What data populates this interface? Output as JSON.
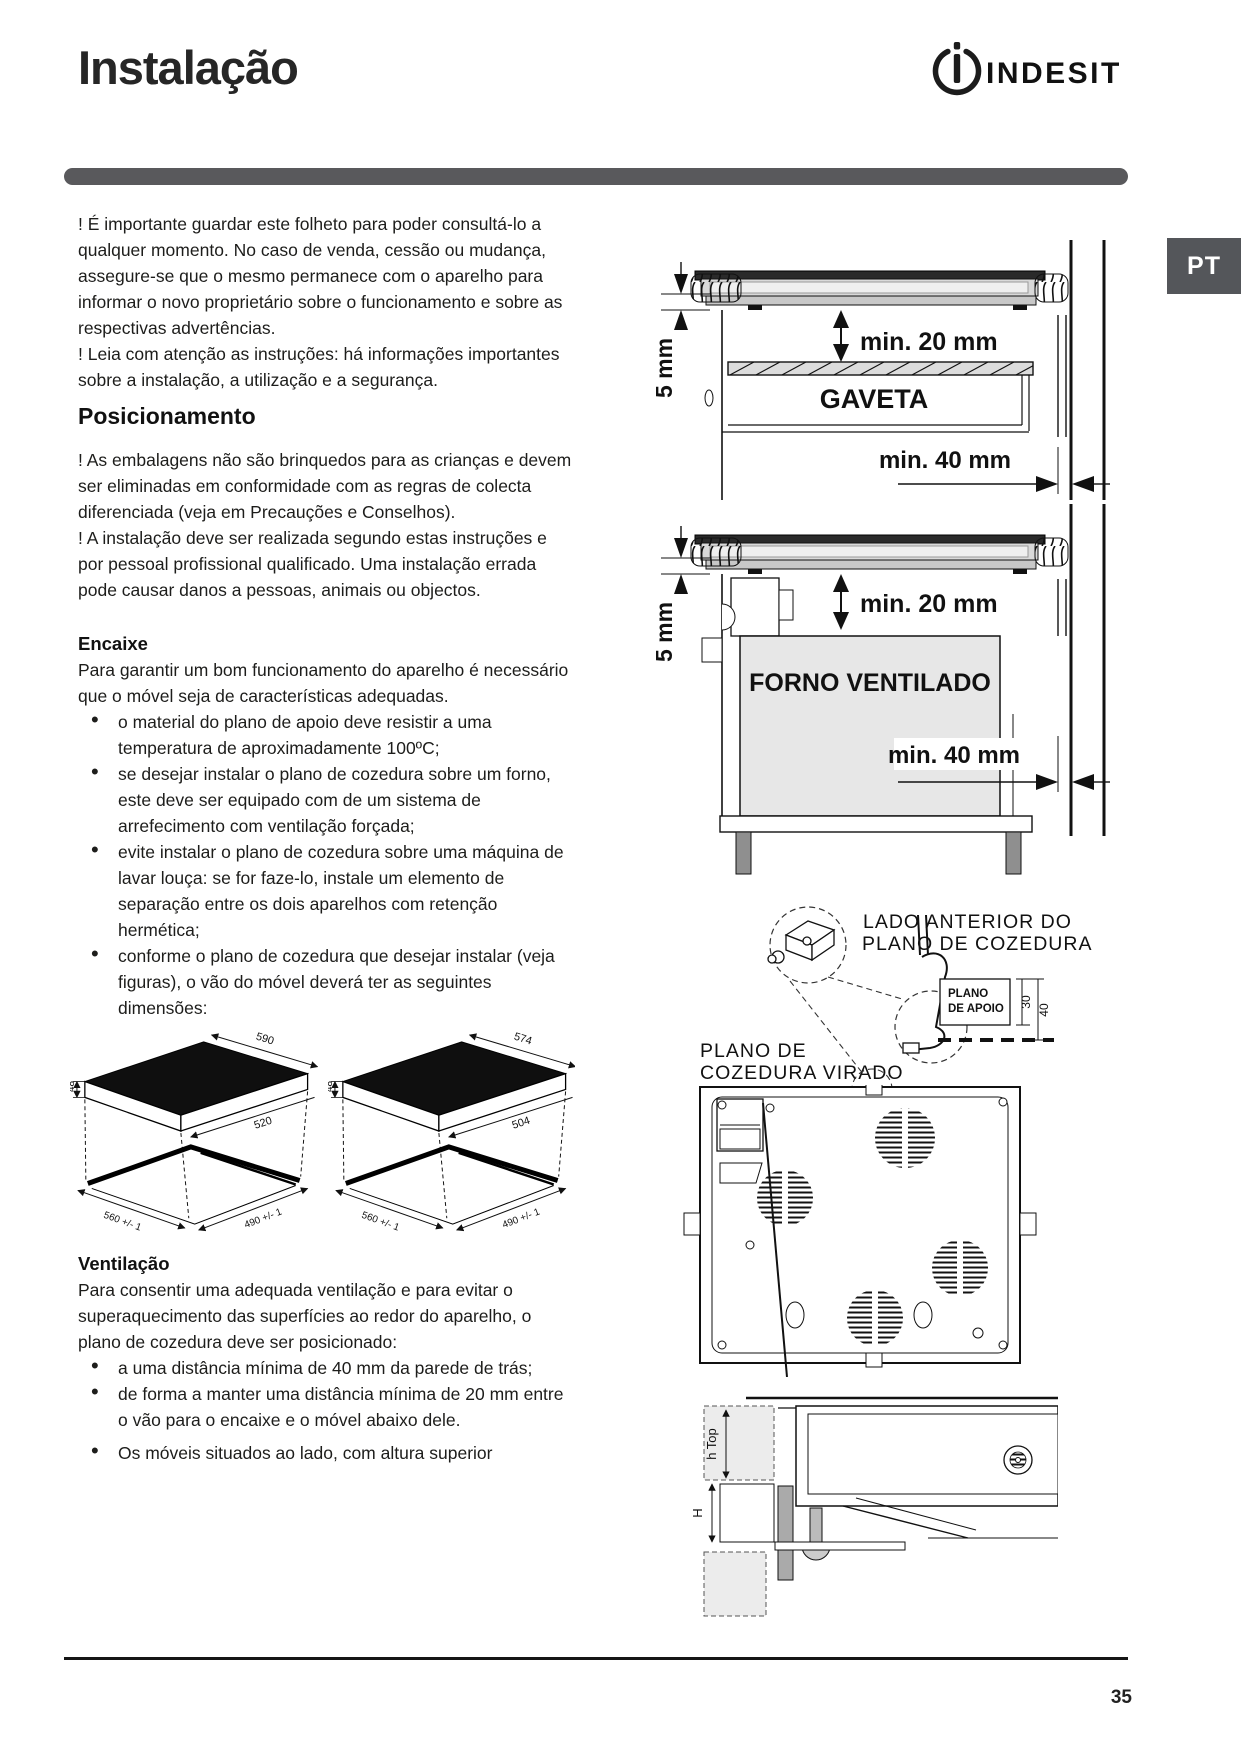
{
  "page": {
    "title": "Instalação",
    "page_number": "35"
  },
  "brand": {
    "logo_text": "INDESIT"
  },
  "tab": {
    "label": "PT"
  },
  "intro": {
    "p1": "! É importante guardar este folheto para poder consultá-lo a qualquer momento. No caso de venda, cessão ou mudança, assegure-se que o mesmo permanece com o aparelho para informar o novo proprietário sobre o funcionamento e sobre as respectivas advertências.",
    "p2": "! Leia com atenção as instruções: há informações importantes sobre a instalação, a utilização e a segurança."
  },
  "sections": {
    "posicionamento": {
      "heading": "Posicionamento",
      "p1": "! As embalagens não são brinquedos para as crianças e devem ser eliminadas em conformidade com as regras de colecta diferenciada (veja em Precauções e Conselhos).",
      "p2": "! A instalação deve ser realizada segundo estas instruções e por pessoal profissional qualificado. Uma instalação errada pode causar danos a pessoas, animais ou objectos."
    },
    "encaixe": {
      "heading": "Encaixe",
      "intro": "Para garantir um bom funcionamento do aparelho é necessário que o móvel seja de características adequadas.",
      "bullets": [
        "o material do plano de apoio deve resistir a uma temperatura de aproximadamente 100ºC;",
        "se desejar instalar o plano de cozedura sobre um forno, este deve ser equipado com de um sistema de arrefecimento com ventilação forçada;",
        "evite instalar o plano de cozedura sobre uma máquina de lavar louça: se for faze-lo, instale um elemento de separação entre os dois aparelhos com retenção hermética;",
        "conforme o plano de cozedura que desejar instalar (veja figuras), o vão do móvel deverá ter as seguintes dimensões:"
      ]
    },
    "ventilacao": {
      "heading": "Ventilação",
      "intro": "Para consentir uma adequada ventilação e para evitar o superaquecimento das superfícies ao redor do aparelho, o plano de cozedura deve ser posicionado:",
      "bullets": [
        "a uma distância mínima de 40 mm da parede de trás;",
        "de forma a manter uma distância mínima de 20 mm entre o vão para o encaixe e o móvel abaixo dele.",
        "Os móveis situados ao lado, com altura superior"
      ]
    }
  },
  "figures": {
    "gaveta": {
      "gap": "5 mm",
      "top_clearance": "min. 20 mm",
      "label": "GAVETA",
      "rear_clearance": "min. 40 mm"
    },
    "forno": {
      "gap": "5 mm",
      "top_clearance": "min. 20 mm",
      "label": "FORNO VENTILADO",
      "rear_clearance": "min. 40 mm"
    },
    "hob_590": {
      "width": "590",
      "height": "48",
      "depth": "520",
      "cutout_width": "560 +/- 1",
      "cutout_depth": "490 +/- 1"
    },
    "hob_574": {
      "width": "574",
      "height": "48",
      "depth": "504",
      "cutout_width": "560 +/- 1",
      "cutout_depth": "490 +/- 1"
    },
    "mounting": {
      "front_label_1": "LADO ANTERIOR DO",
      "front_label_2": "PLANO DE COZEDURA",
      "support_label_1": "PLANO",
      "support_label_2": "DE APOIO",
      "dim_30": "30",
      "dim_40": "40",
      "flipped_label_1": "PLANO DE",
      "flipped_label_2": "COZEDURA VIRADO"
    },
    "section_view": {
      "dim_h_top": "h Top",
      "dim_h": "H"
    }
  },
  "colors": {
    "bar": "#59595c",
    "tab": "#54565a",
    "oven_fill": "#e7e7e7",
    "hob_top": "#111111"
  }
}
